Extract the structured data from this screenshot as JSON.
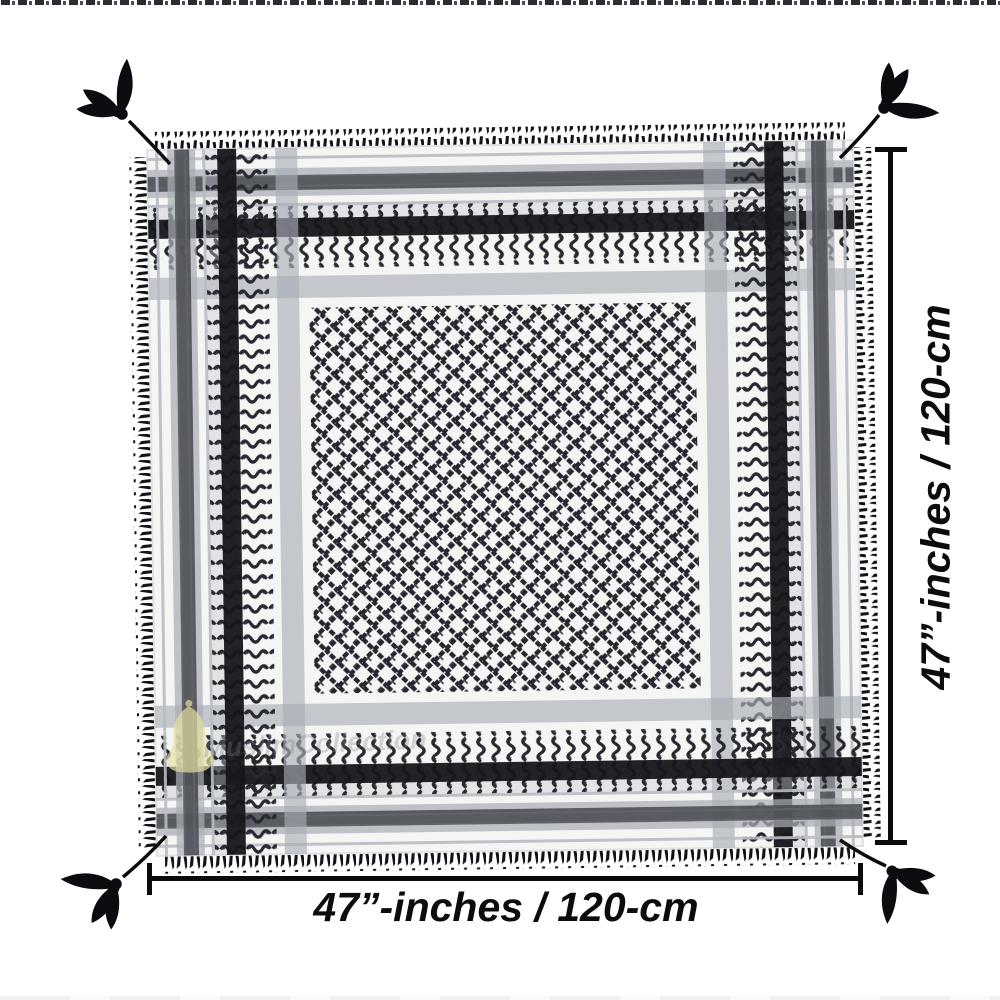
{
  "page": {
    "background_color": "#ffffff"
  },
  "product_photo": {
    "subject": "black-and-white-keffiyeh-shemagh-scarf",
    "colors": {
      "fabric": "#f5f5f3",
      "pattern_black": "#24272d",
      "stripe_black": "#16171b",
      "band_grey": "#a9aeb6",
      "tassel_black": "#0b0c0f"
    }
  },
  "annotations": {
    "width_label": "47”-inches / 120-cm",
    "height_label": "47”-inches / 120-cm",
    "line_color": "#0b0b0c"
  },
  "watermark": {
    "text": "MuslimCollection",
    "text_color": "#7d848d",
    "emblem": "dome-emblem",
    "emblem_color": "#e8e2a2"
  }
}
